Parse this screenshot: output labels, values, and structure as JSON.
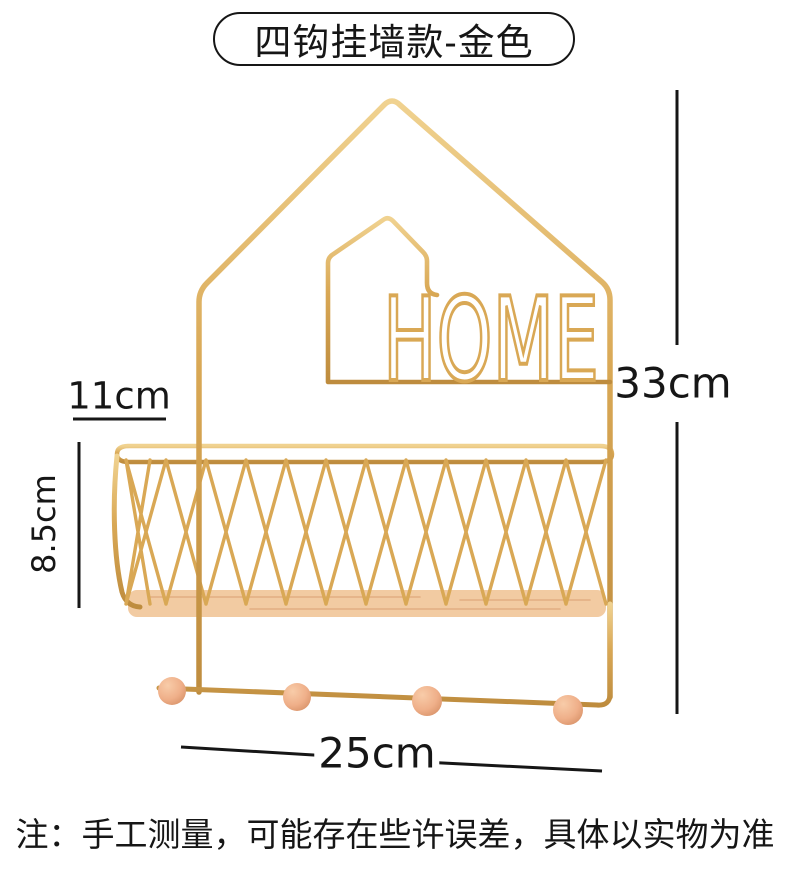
{
  "title": {
    "label": "四钩挂墙款-金色"
  },
  "home_sign": "HOME",
  "dimensions": {
    "top_width": "11cm",
    "basket_height": "8.5cm",
    "total_height": "33cm",
    "bottom_width": "25cm"
  },
  "note": "注：手工测量，可能存在些许误差，具体以实物为准",
  "hook_count": 4,
  "colors": {
    "gold": "#D9A855",
    "gold_light": "#F0D290",
    "gold_dark": "#BE8C3E",
    "wood": "#F2CBA2",
    "wood_dark": "#E2AE82",
    "bead": "#EFAF89",
    "bead_light": "#F8CCA9",
    "bead_dark": "#D18A5F",
    "ink": "#161616"
  }
}
